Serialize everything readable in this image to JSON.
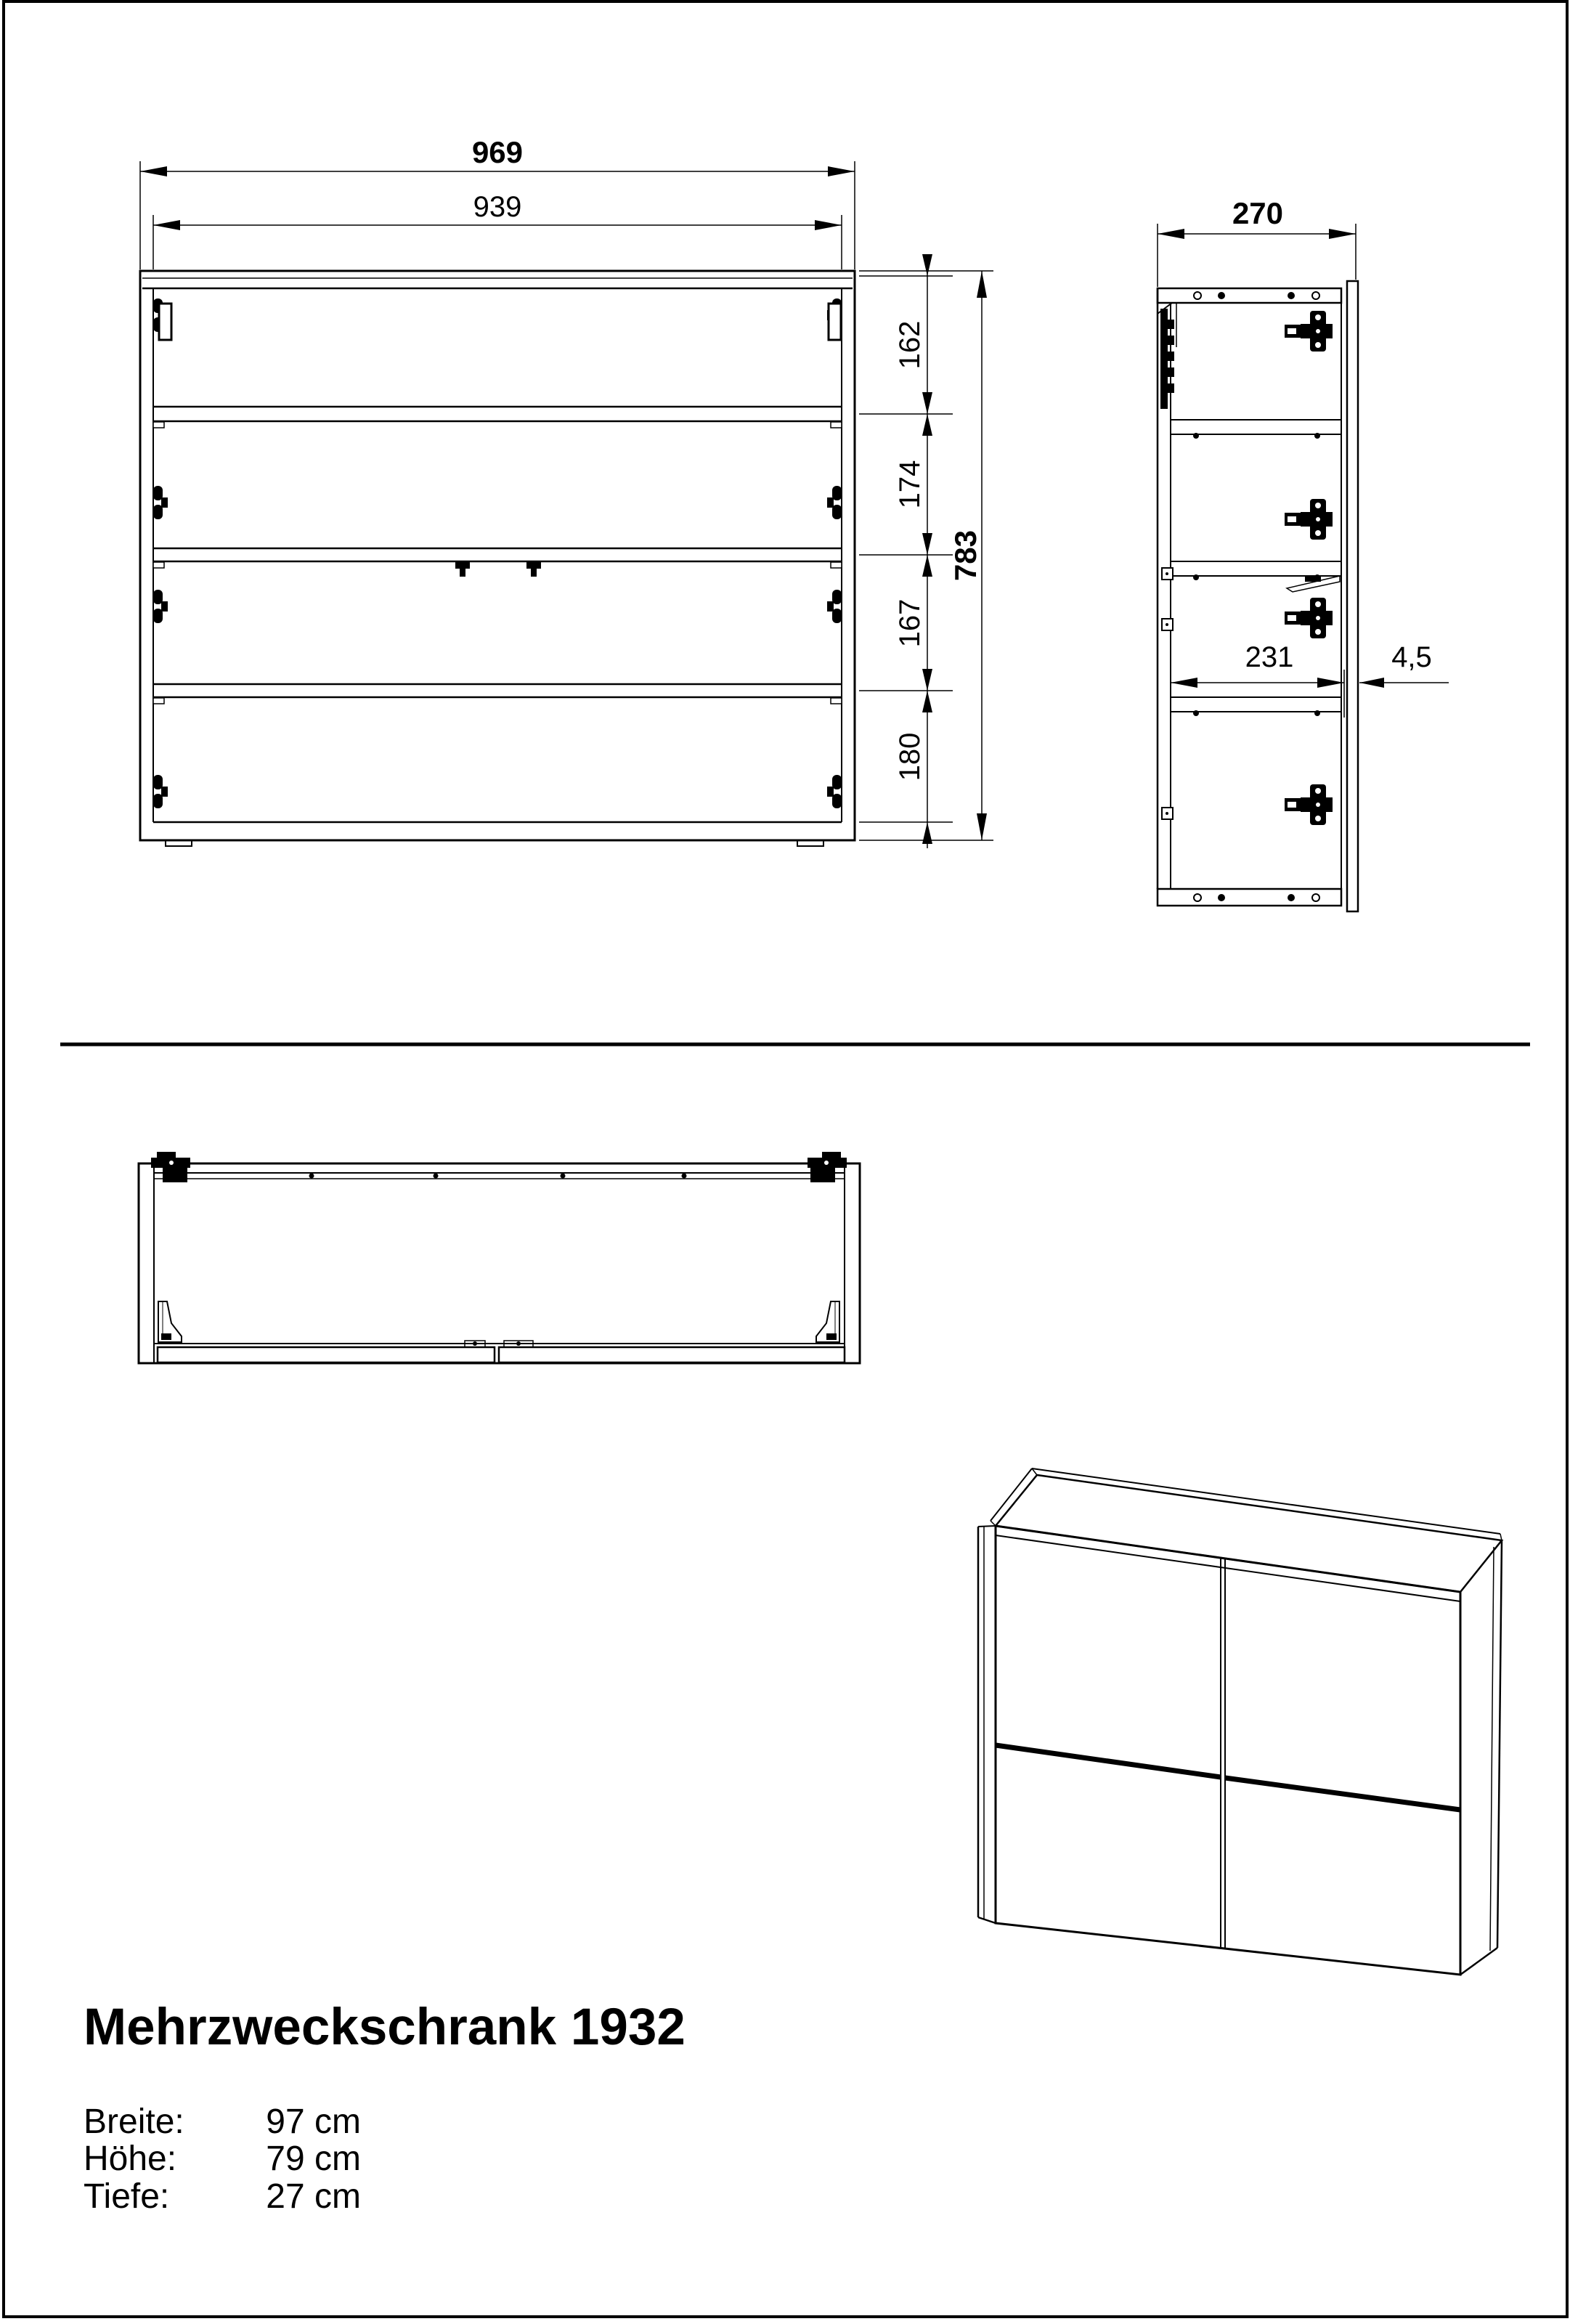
{
  "title": "Mehrzweckschrank 1932",
  "specs": {
    "rows": [
      {
        "label": "Breite:",
        "value": "97 cm"
      },
      {
        "label": "Höhe:",
        "value": "79 cm"
      },
      {
        "label": "Tiefe:",
        "value": "27 cm"
      }
    ]
  },
  "front_view": {
    "width_total": "969",
    "width_inner": "939",
    "section_heights": [
      "162",
      "174",
      "167",
      "180"
    ],
    "height_total": "783"
  },
  "side_view": {
    "depth_total": "270",
    "depth_inner": "231",
    "gap_thickness": "4,5"
  }
}
